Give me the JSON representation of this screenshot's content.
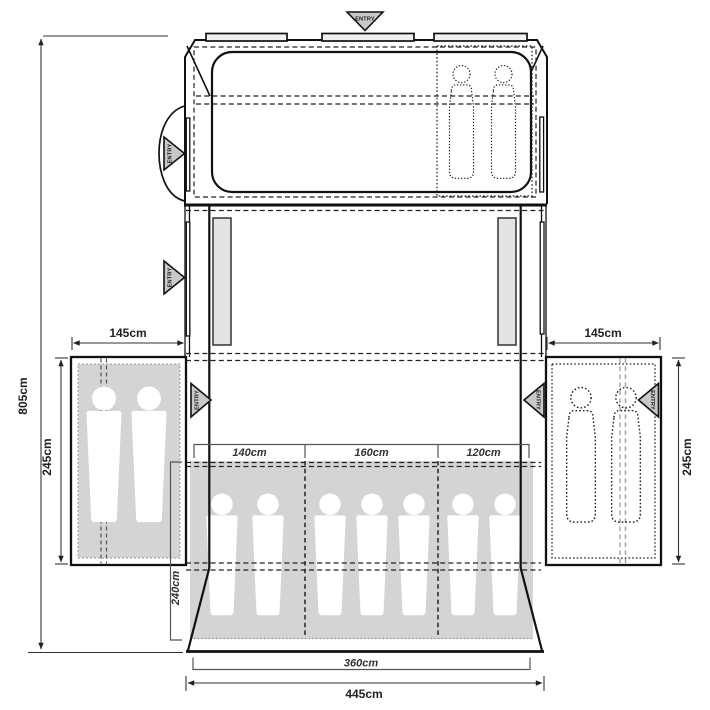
{
  "diagram": {
    "type": "tent-floorplan",
    "colors": {
      "line": "#111111",
      "area_gray": "#d4d4d4",
      "window_gray": "#e4e4e4",
      "entry_triangle_gray": "#c9c9c9",
      "vent_bar_fill": "#f1f1f1",
      "background": "#ffffff"
    }
  },
  "labels": {
    "entry": "ENTRY",
    "overall_length": "805cm",
    "overall_width": "445cm",
    "inner_width": "360cm",
    "rear_bedroom_depth": "240cm",
    "left_annex": {
      "width": "145cm",
      "depth": "245cm"
    },
    "right_annex": {
      "width": "145cm",
      "depth": "245cm"
    },
    "rear_bedrooms": {
      "left": "140cm",
      "middle": "160cm",
      "right": "120cm"
    }
  }
}
